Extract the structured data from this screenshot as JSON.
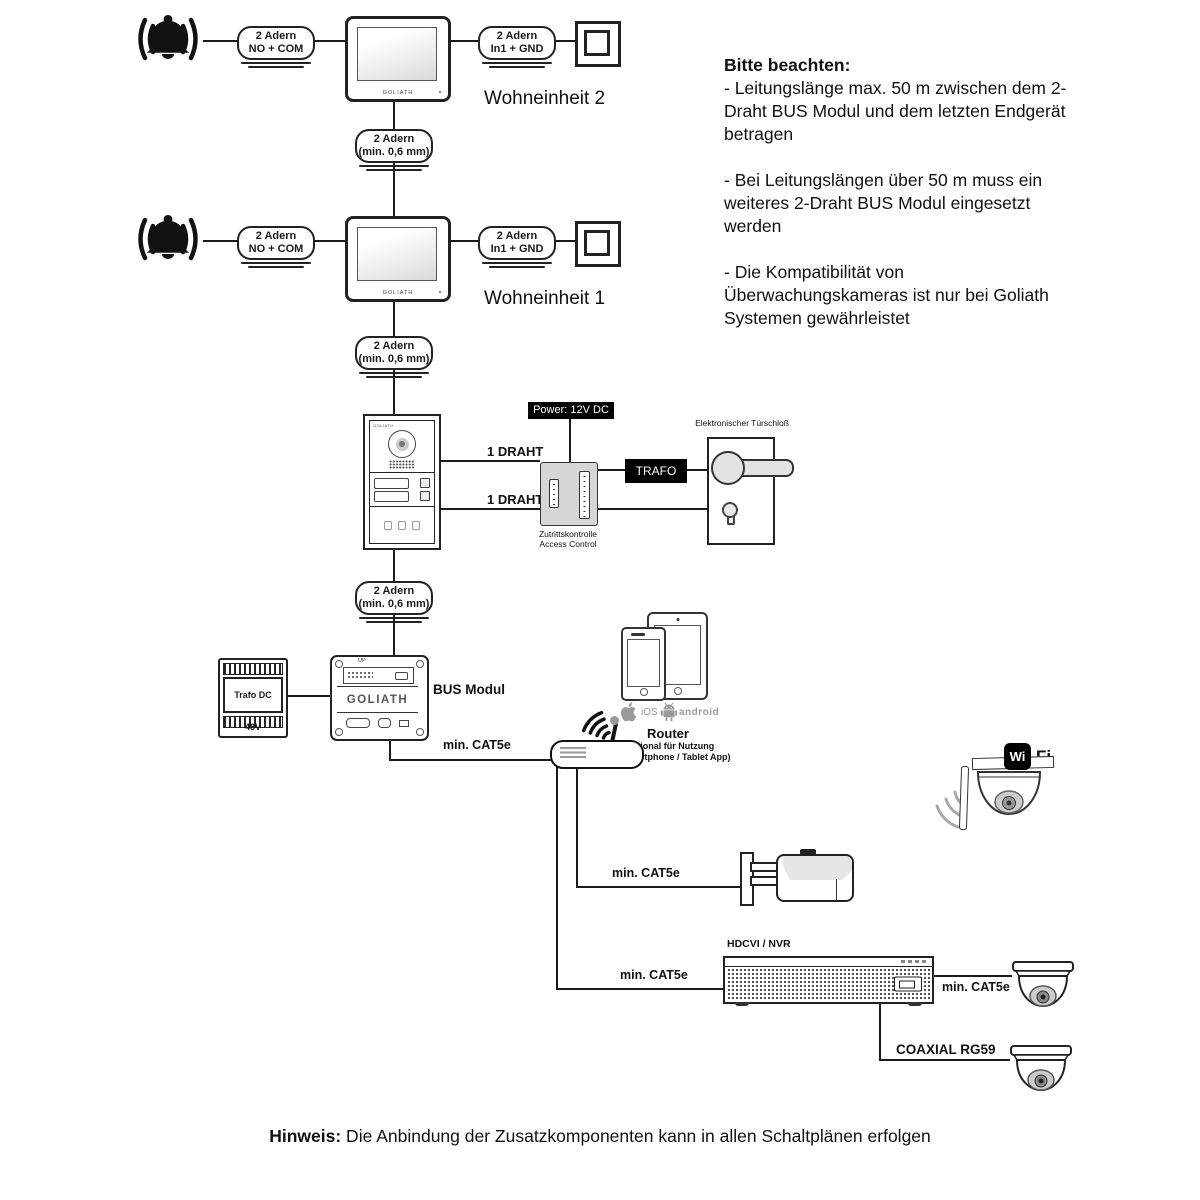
{
  "brand": "GOLIATH",
  "units": [
    {
      "name": "Wohneinheit 2"
    },
    {
      "name": "Wohneinheit 1"
    }
  ],
  "pills": {
    "bell": [
      "2 Adern",
      "NO + COM"
    ],
    "door_button": [
      "2 Adern",
      "In1 + GND"
    ],
    "riser": [
      "2 Adern",
      "(min. 0,6 mm)"
    ]
  },
  "access": {
    "power": "Power: 12V DC",
    "wire": "1 DRAHT",
    "trafo": "TRAFO",
    "lock_title": "Elektronischer Türschloß",
    "control_de": "Zutrittskontrolle",
    "control_en": "Access Control"
  },
  "bus": {
    "trafo_label": "Trafo DC 48V",
    "module_label": "BUS Modul",
    "up": "UP"
  },
  "network": {
    "cat5": "min. CAT5e",
    "coax": "COAXIAL RG59",
    "router_title": "Router",
    "router_sub1": "(Optional für Nutzung",
    "router_sub2": "der Smartphone / Tablet App)",
    "ios": "iOS",
    "android": "android",
    "wifi_wi": "Wi",
    "wifi_fi": "Fi",
    "nvr": "HDCVI / NVR"
  },
  "notes": {
    "title": "Bitte beachten:",
    "p1": "- Leitungslänge max. 50 m zwischen dem 2-Draht BUS Modul und dem letzten Endgerät betragen",
    "p2": "- Bei Leitungslängen über 50 m muss ein weiteres 2-Draht BUS Modul eingesetzt werden",
    "p3": "- Die Kompatibilität von Überwachungskameras ist nur bei Goliath Systemen gewährleistet"
  },
  "footer": {
    "bold": "Hinweis:",
    "text": " Die Anbindung der Zusatzkomponenten kann in allen Schaltplänen erfolgen"
  },
  "colors": {
    "line": "#1a1a1a",
    "panel_gray": "#d6d6d6",
    "icon_gray": "#9a9a9a"
  }
}
